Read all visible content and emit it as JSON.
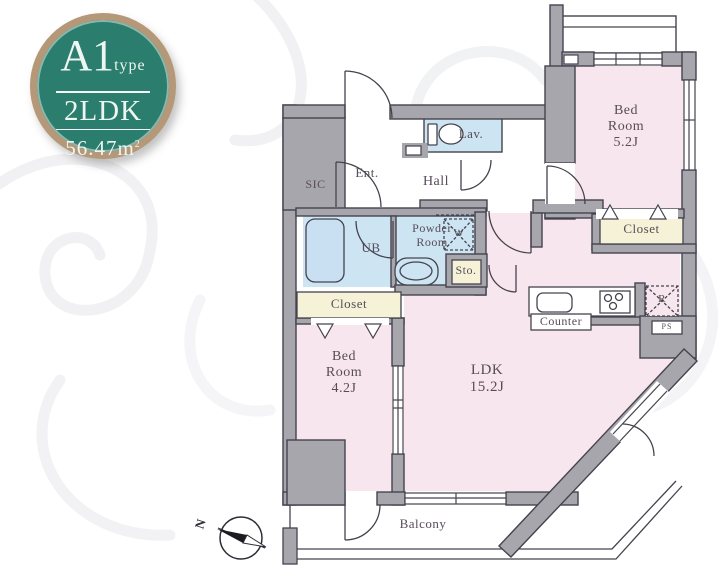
{
  "badge": {
    "plan_name": "A1",
    "plan_suffix": "type",
    "layout": "2LDK",
    "area": "56.47m",
    "area_sup": "2"
  },
  "rooms": {
    "bedroom1": {
      "line1": "Bed",
      "line2": "Room",
      "size": "5.2J"
    },
    "bedroom2": {
      "line1": "Bed",
      "line2": "Room",
      "size": "4.2J"
    },
    "ldk": {
      "line1": "LDK",
      "size": "15.2J"
    },
    "hall": "Hall",
    "entrance": "Ent.",
    "sic": "SIC",
    "ub": "UB",
    "lavatory": "Lav.",
    "powder_line1": "Powder",
    "powder_line2": "Room",
    "storage": "Sto.",
    "closet_left": "Closet",
    "closet_right": "Closet",
    "counter": "Counter",
    "washer": "W",
    "refrigerator": "R",
    "pipe_space": "PS",
    "balcony": "Balcony"
  },
  "compass": {
    "north_label": "N"
  },
  "colors": {
    "wall_gray": "#a8a6ad",
    "outline": "#45434e",
    "room_pink": "#f8e6ee",
    "water_blue": "#cde4f3",
    "storage_cream": "#f6f2d7",
    "badge_green": "#2b7d6d",
    "badge_ring_tan": "#b59878",
    "label_text": "#564d58"
  }
}
